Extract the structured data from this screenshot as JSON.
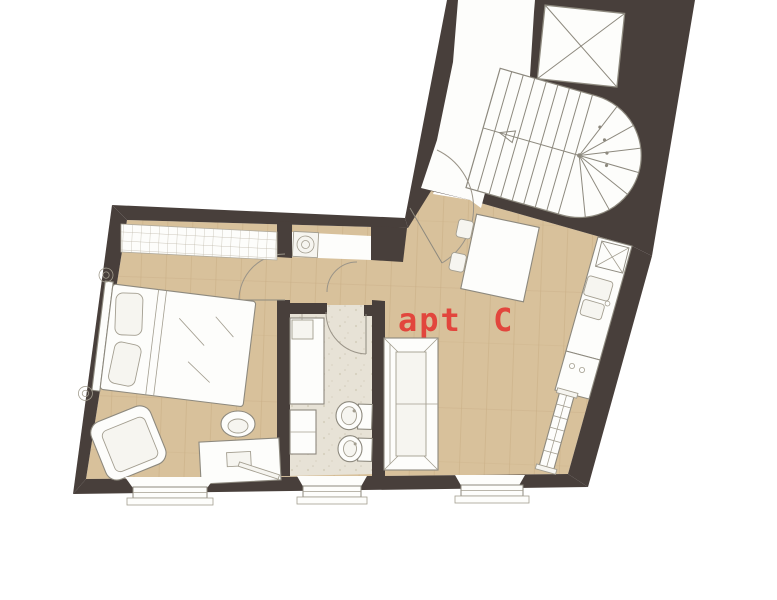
{
  "plan": {
    "apartment_label": "apt C",
    "colors": {
      "wall": "#483f3b",
      "wood_floor": "#d8c19b",
      "wood_grain": "#c3a87f",
      "tile_floor": "#e7e2d6",
      "outline": "#8d897e",
      "furniture_fill": "#fdfdfb",
      "label_red": "#e2463d",
      "background": "#ffffff"
    },
    "rooms": [
      {
        "name": "bedroom"
      },
      {
        "name": "bathroom"
      },
      {
        "name": "living-room-kitchen"
      },
      {
        "name": "entry-hall"
      },
      {
        "name": "stairwell"
      }
    ],
    "elements": [
      "staircase",
      "stair-walking-line",
      "lift-shaft",
      "stair-landing",
      "entry-door",
      "bedroom-door",
      "bathroom-door",
      "closet-door",
      "wardrobe",
      "washing-machine",
      "double-bed",
      "pillows",
      "bedside-lamp",
      "bedside-lamp",
      "armchair",
      "desk",
      "desk-chair",
      "shower-counter",
      "washbasin",
      "bathroom-cabinet",
      "toilet",
      "bidet",
      "sofa",
      "dining-table",
      "dining-chair",
      "dining-chair",
      "kitchen-counter",
      "kitchen-sink",
      "cooktop",
      "vent-shaft",
      "radiator",
      "window",
      "window",
      "window"
    ]
  }
}
